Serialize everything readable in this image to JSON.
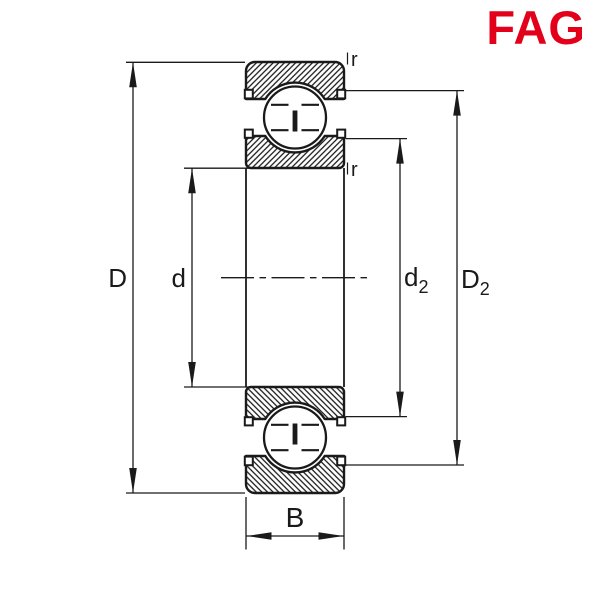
{
  "logo": {
    "text": "FAG",
    "color": "#E2001A"
  },
  "drawing": {
    "background": "#ffffff",
    "line_color": "#1a1a1a",
    "labels": {
      "outer_diameter": "D",
      "bore_diameter": "d",
      "d2_base": "d",
      "d2_sub": "2",
      "D2_base": "D",
      "D2_sub": "2",
      "width": "B",
      "r_outer": "r",
      "r_bore": "r"
    }
  }
}
